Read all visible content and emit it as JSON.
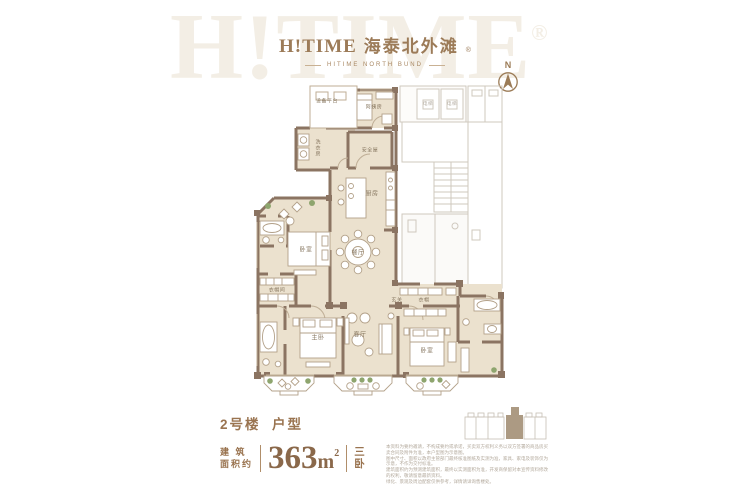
{
  "brand": {
    "watermark": "H!TIME",
    "registered": "®",
    "logo_text": "H!TIME",
    "logo_cn": "海泰北外滩",
    "subtitle": "HITIME NORTH BUND"
  },
  "compass": {
    "north_label": "N"
  },
  "plan": {
    "rooms": [
      {
        "label": "设备平台"
      },
      {
        "label": "阿姨房"
      },
      {
        "label": "洗衣房"
      },
      {
        "label": "安全屋"
      },
      {
        "label": "厨房"
      },
      {
        "label": "餐厅"
      },
      {
        "label": "卧室"
      },
      {
        "label": "衣帽间"
      },
      {
        "label": "玄关"
      },
      {
        "label": "衣帽"
      },
      {
        "label": "主卧"
      },
      {
        "label": "客厅"
      },
      {
        "label": "卧室"
      },
      {
        "label": "电梯"
      },
      {
        "label": "电梯"
      }
    ]
  },
  "unit_info": {
    "building": "2号楼",
    "type_label": "户型",
    "area_label_line1": "建 筑",
    "area_label_line2": "面积约",
    "area_value": "363",
    "area_unit": "m",
    "area_exponent": "2",
    "layout_char_top": "三",
    "layout_char_bottom": "卧"
  },
  "disclaimer": {
    "lines": [
      "本资料为要约邀请，不构成要约或承诺，买卖双方权利义务以双方签署的商品房买卖合同及附件为准，本户型图为示意图。",
      "图中尺寸、面积以政府主管部门最终核准图纸及实测为准，家具、家电及装饰仅为示意，不作为交付标准。",
      "建筑面积约为预测建筑面积，最终以实测面积为准，开发商保留对本宣传资料修改的权利，敬请留意最新资料。",
      "绿化、景观及周边配套仅供参考，详情请详询售楼处。"
    ]
  },
  "colors": {
    "brand_brown": "#9c7b58",
    "wall_brown": "#8b7462",
    "floor_beige": "#ebe1ce",
    "accent_green": "#8ea56e",
    "core_gray": "#cfc8be",
    "fine_print_gray": "#b3a99c"
  }
}
